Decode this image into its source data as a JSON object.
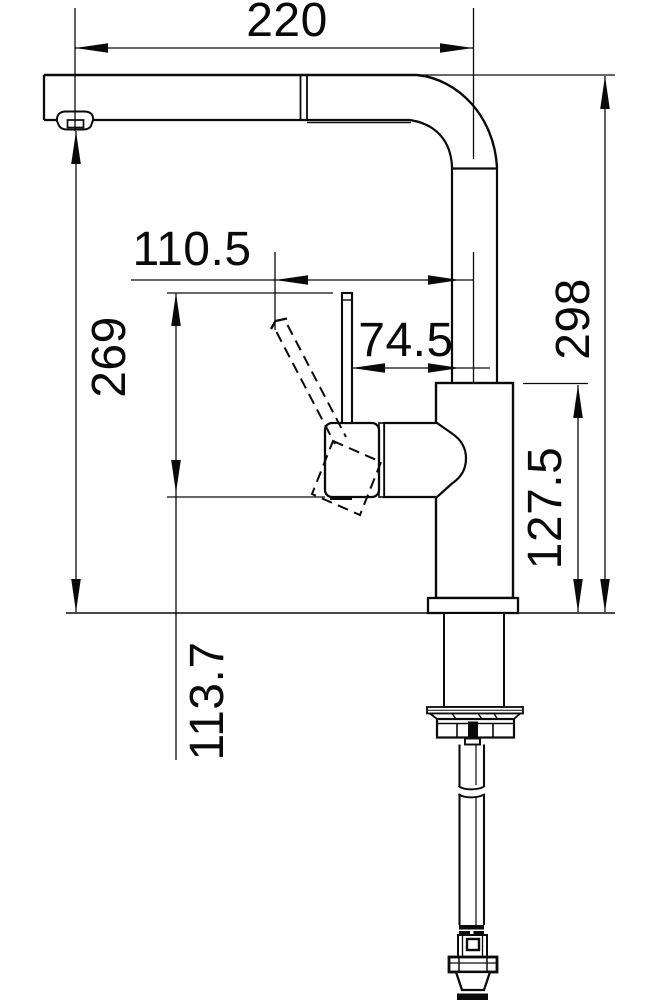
{
  "drawing": {
    "type": "technical-dimension-drawing",
    "subject": "kitchen-faucet-side-view-with-pull-out-spray",
    "background": "#ffffff",
    "line_color": "#0a0a0a",
    "dimensions": {
      "spout_reach": "220",
      "lever_tip_offset": "110.5",
      "lever_offset": "74.5",
      "total_height": "298",
      "spout_outlet_height": "269",
      "body_top_height": "127.5",
      "lever_height": "113.7"
    }
  }
}
